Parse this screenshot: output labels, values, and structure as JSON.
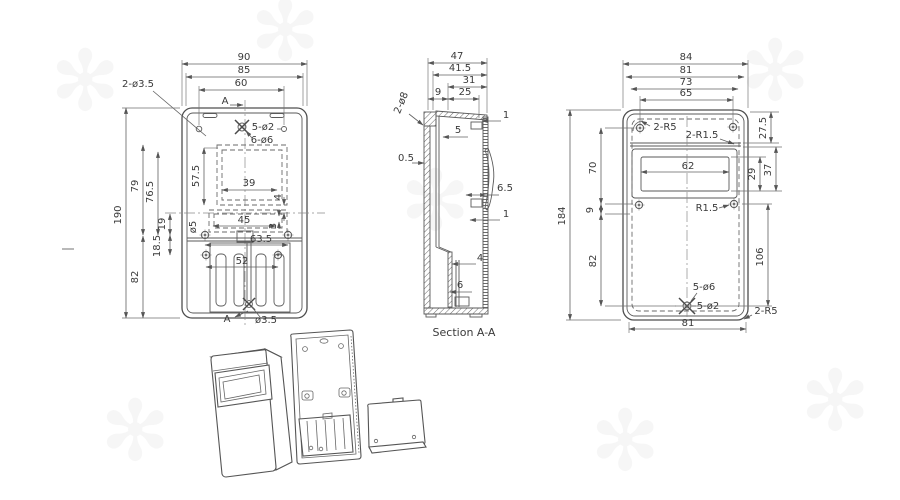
{
  "drawing": {
    "front": {
      "d90": "90",
      "d85": "85",
      "d60": "60",
      "hole_note": "2-ø3.5",
      "sec_top": "A",
      "sec_bottom": "A",
      "note_5d2": "5-ø2",
      "note_6d6": "6-ø6",
      "d190": "190",
      "d79": "79",
      "d76_5": "76.5",
      "d57_5": "57.5",
      "d39": "39",
      "d45": "45",
      "d63_5": "63.5",
      "d52": "52",
      "d82": "82",
      "d18_5": "18.5",
      "d19": "19",
      "d_o5": "ø5",
      "d4": "4",
      "d3": "3",
      "note_d35": "ø3.5"
    },
    "side": {
      "d47": "47",
      "d41_5": "41.5",
      "d31": "31",
      "d25": "25",
      "d9": "9",
      "note_2d8": "2-ø8",
      "d5": "5",
      "d1a": "1",
      "d0_5": "0.5",
      "d6_5": "6.5",
      "d1b": "1",
      "d4": "4",
      "d6": "6",
      "caption": "Section A-A"
    },
    "back": {
      "d84": "84",
      "d81_top": "81",
      "d73": "73",
      "d65": "65",
      "note_2r5_top": "2-R5",
      "note_2r15": "2-R1.5",
      "d27_5": "27.5",
      "d62": "62",
      "d29": "29",
      "d37": "37",
      "d184": "184",
      "d70": "70",
      "d9": "9",
      "d82": "82",
      "note_r15": "R1.5",
      "d106": "106",
      "note_5d6": "5-ø6",
      "note_5d2": "5-ø2",
      "d81_bottom": "81",
      "note_2r5_bottom": "2-R5"
    },
    "colors": {
      "part_line": "#4f4f4f",
      "dim_line": "#606060",
      "text": "#3a3a3a",
      "background": "#ffffff"
    }
  }
}
